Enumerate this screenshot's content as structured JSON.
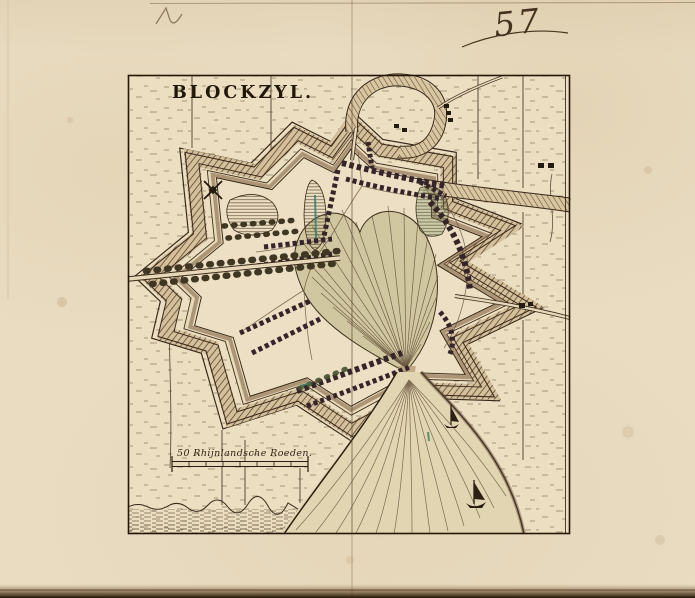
{
  "page": {
    "folio_number": "57"
  },
  "map": {
    "title": "BLOCKZYL.",
    "scale_bar_label": "50 Rhijnlandsche Roeden.",
    "icons": {
      "windmill_icon": "x-cross-sails",
      "sailboat_icon": "triangle-sail-hull",
      "tree_icon": "round-blob-row"
    },
    "colors": {
      "paper": "#e9dcc1",
      "ink": "#2e2114",
      "hatch_brown": "#5d4830",
      "pond_teal": "#2e7d6e",
      "field_green": "#46522e"
    }
  }
}
